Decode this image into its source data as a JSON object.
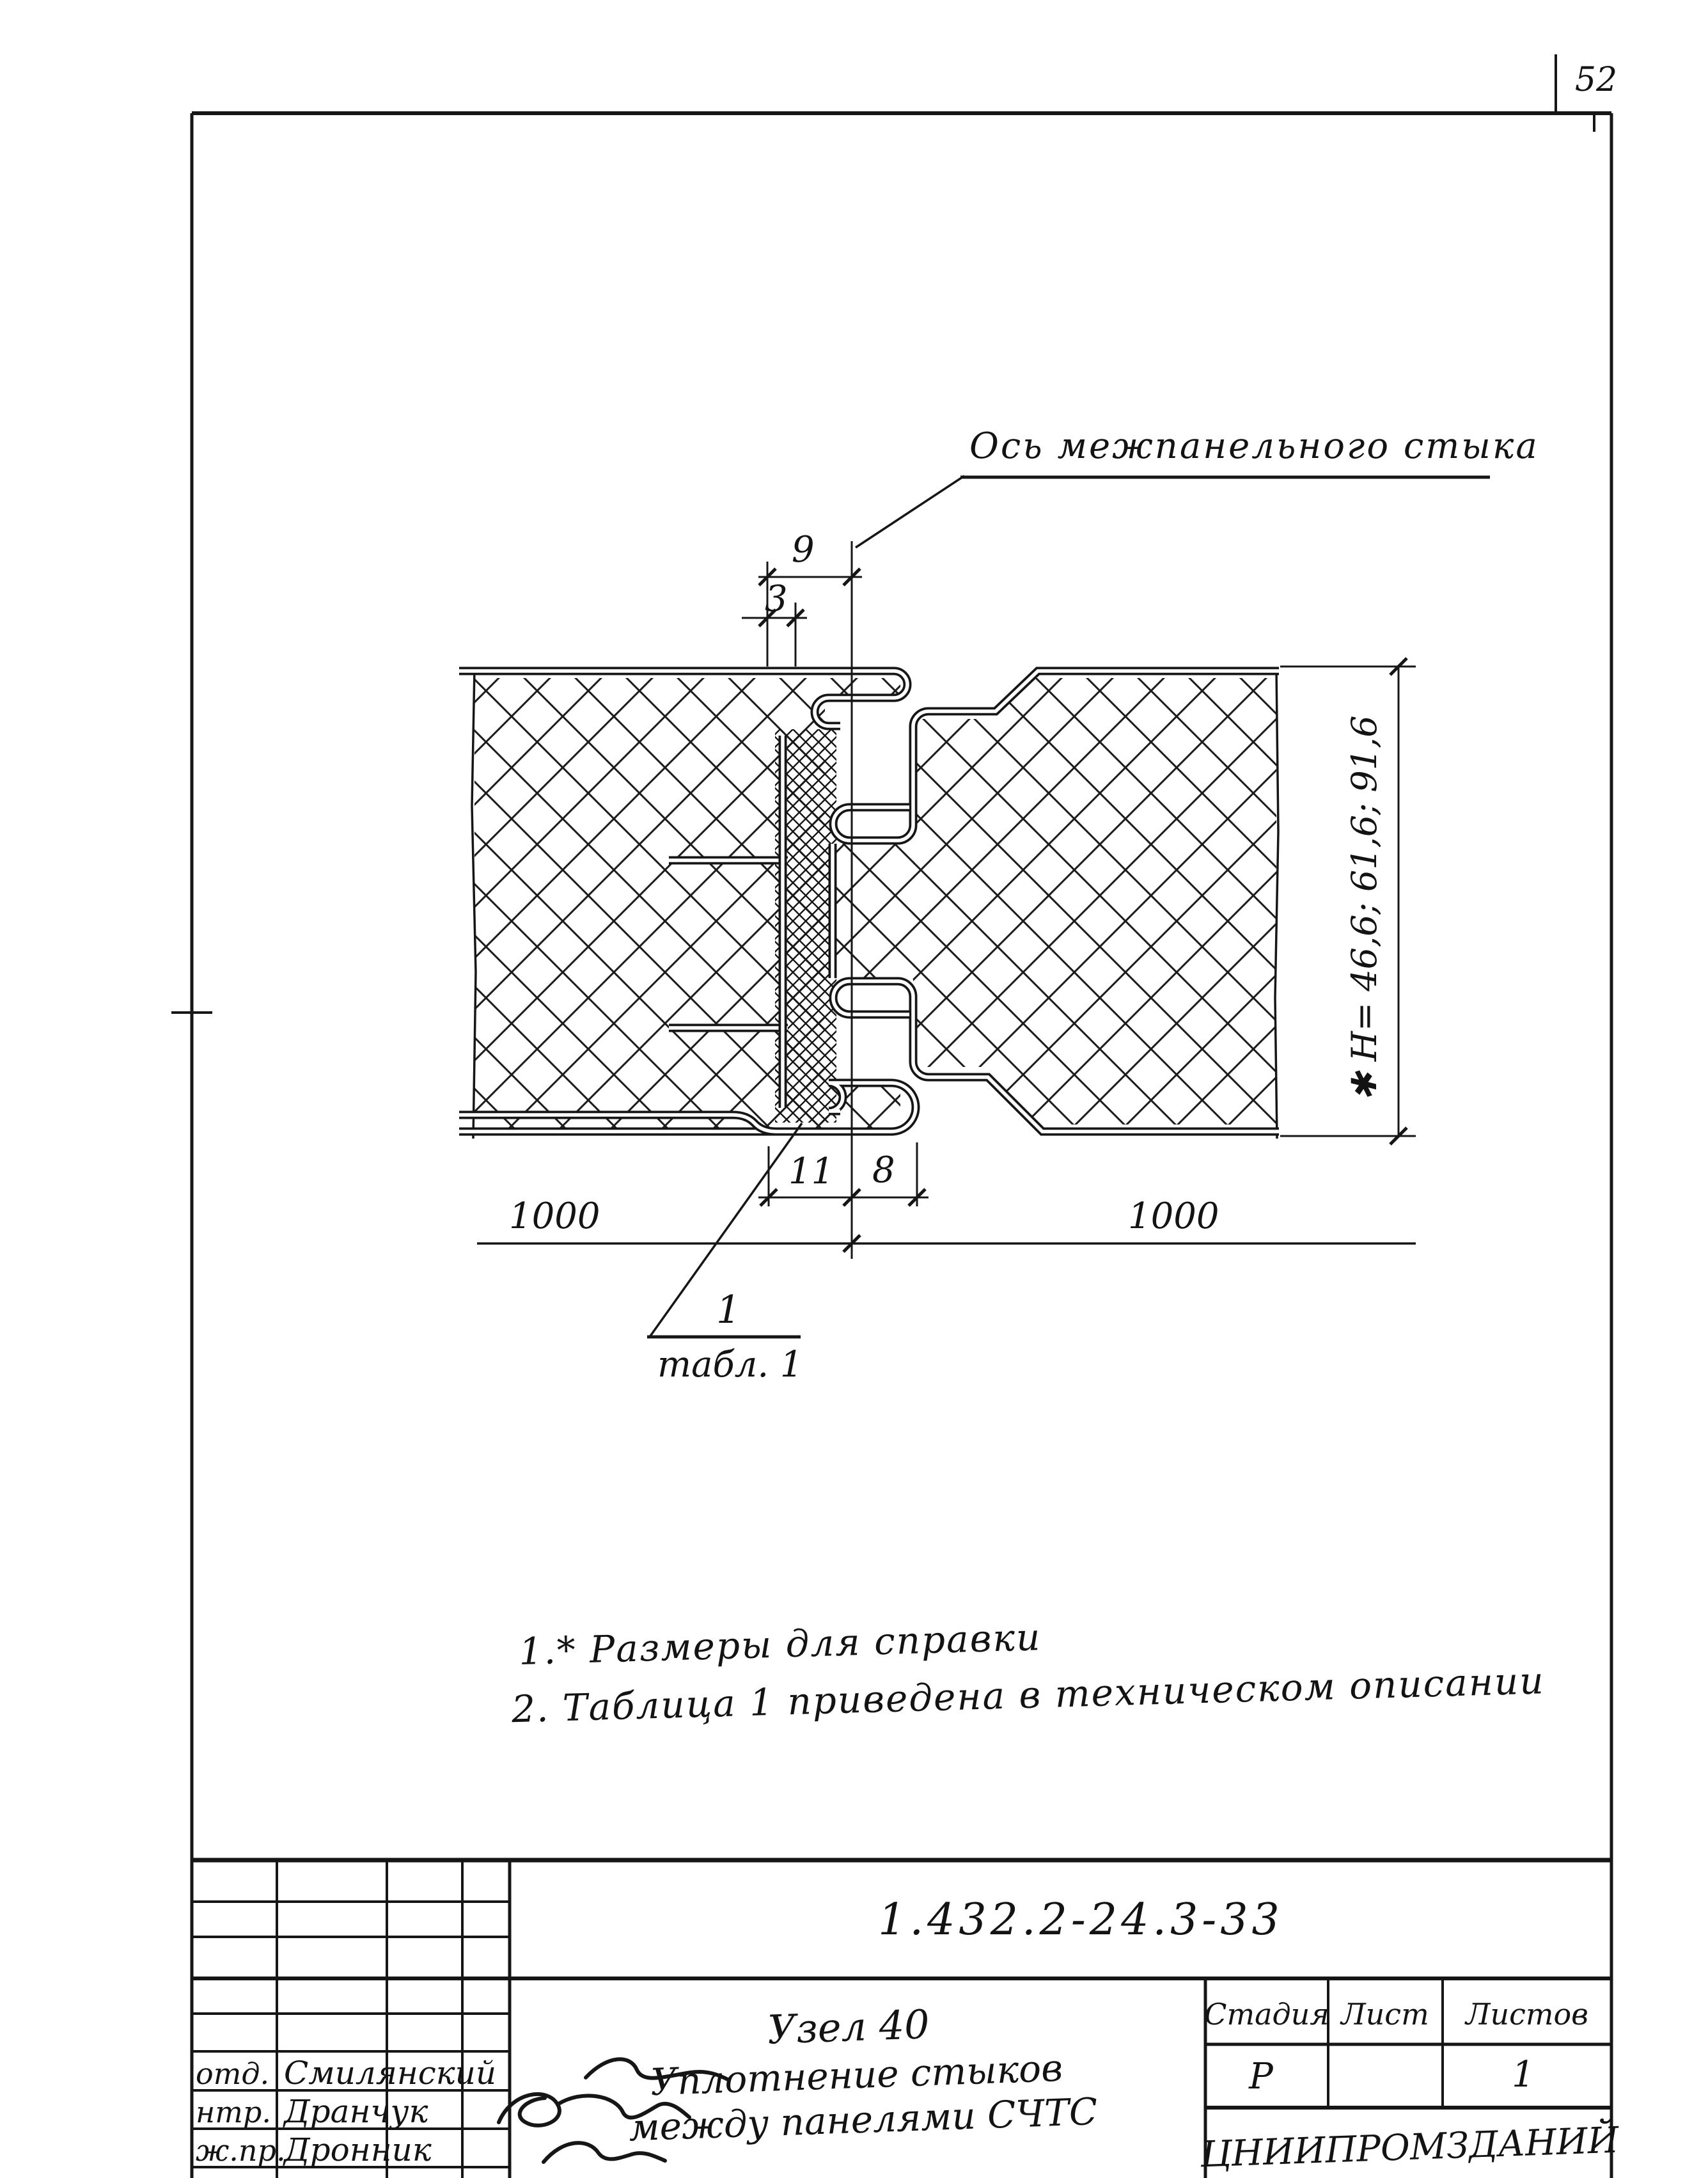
{
  "page": {
    "sheet_number": "52"
  },
  "drawing": {
    "axis_label": "Ось межпанельного стыка",
    "dimensions": {
      "top_offset": "9",
      "top_gap": "3",
      "seal_width": "11",
      "joint_width": "8",
      "panel_left": "1000",
      "panel_right": "1000",
      "thickness": "✱ H= 46,6; 61,6; 91,6"
    },
    "callout": {
      "item": "1",
      "reference": "табл. 1"
    }
  },
  "notes": {
    "line1": "1.* Размеры  для справки",
    "line2": "2. Таблица 1 приведена в техническом описании"
  },
  "title_block": {
    "document_number": "1.432.2-24.3-33",
    "node_title": "Узел 40",
    "subtitle_line1": "Уплотнение стыков",
    "subtitle_line2": "между панелями СЧТС",
    "stage_header": "Стадия",
    "sheet_header": "Лист",
    "sheets_header": "Листов",
    "stage_value": "Р",
    "sheet_value": "",
    "sheets_value": "1",
    "organization": "ЦНИИПРОМЗДАНИЙ",
    "signatures": [
      {
        "role": "отд.",
        "name": "Смилянский"
      },
      {
        "role": "нтр.",
        "name": "Дранчук"
      },
      {
        "role": "ж.пр.",
        "name": "Дронник"
      }
    ]
  }
}
